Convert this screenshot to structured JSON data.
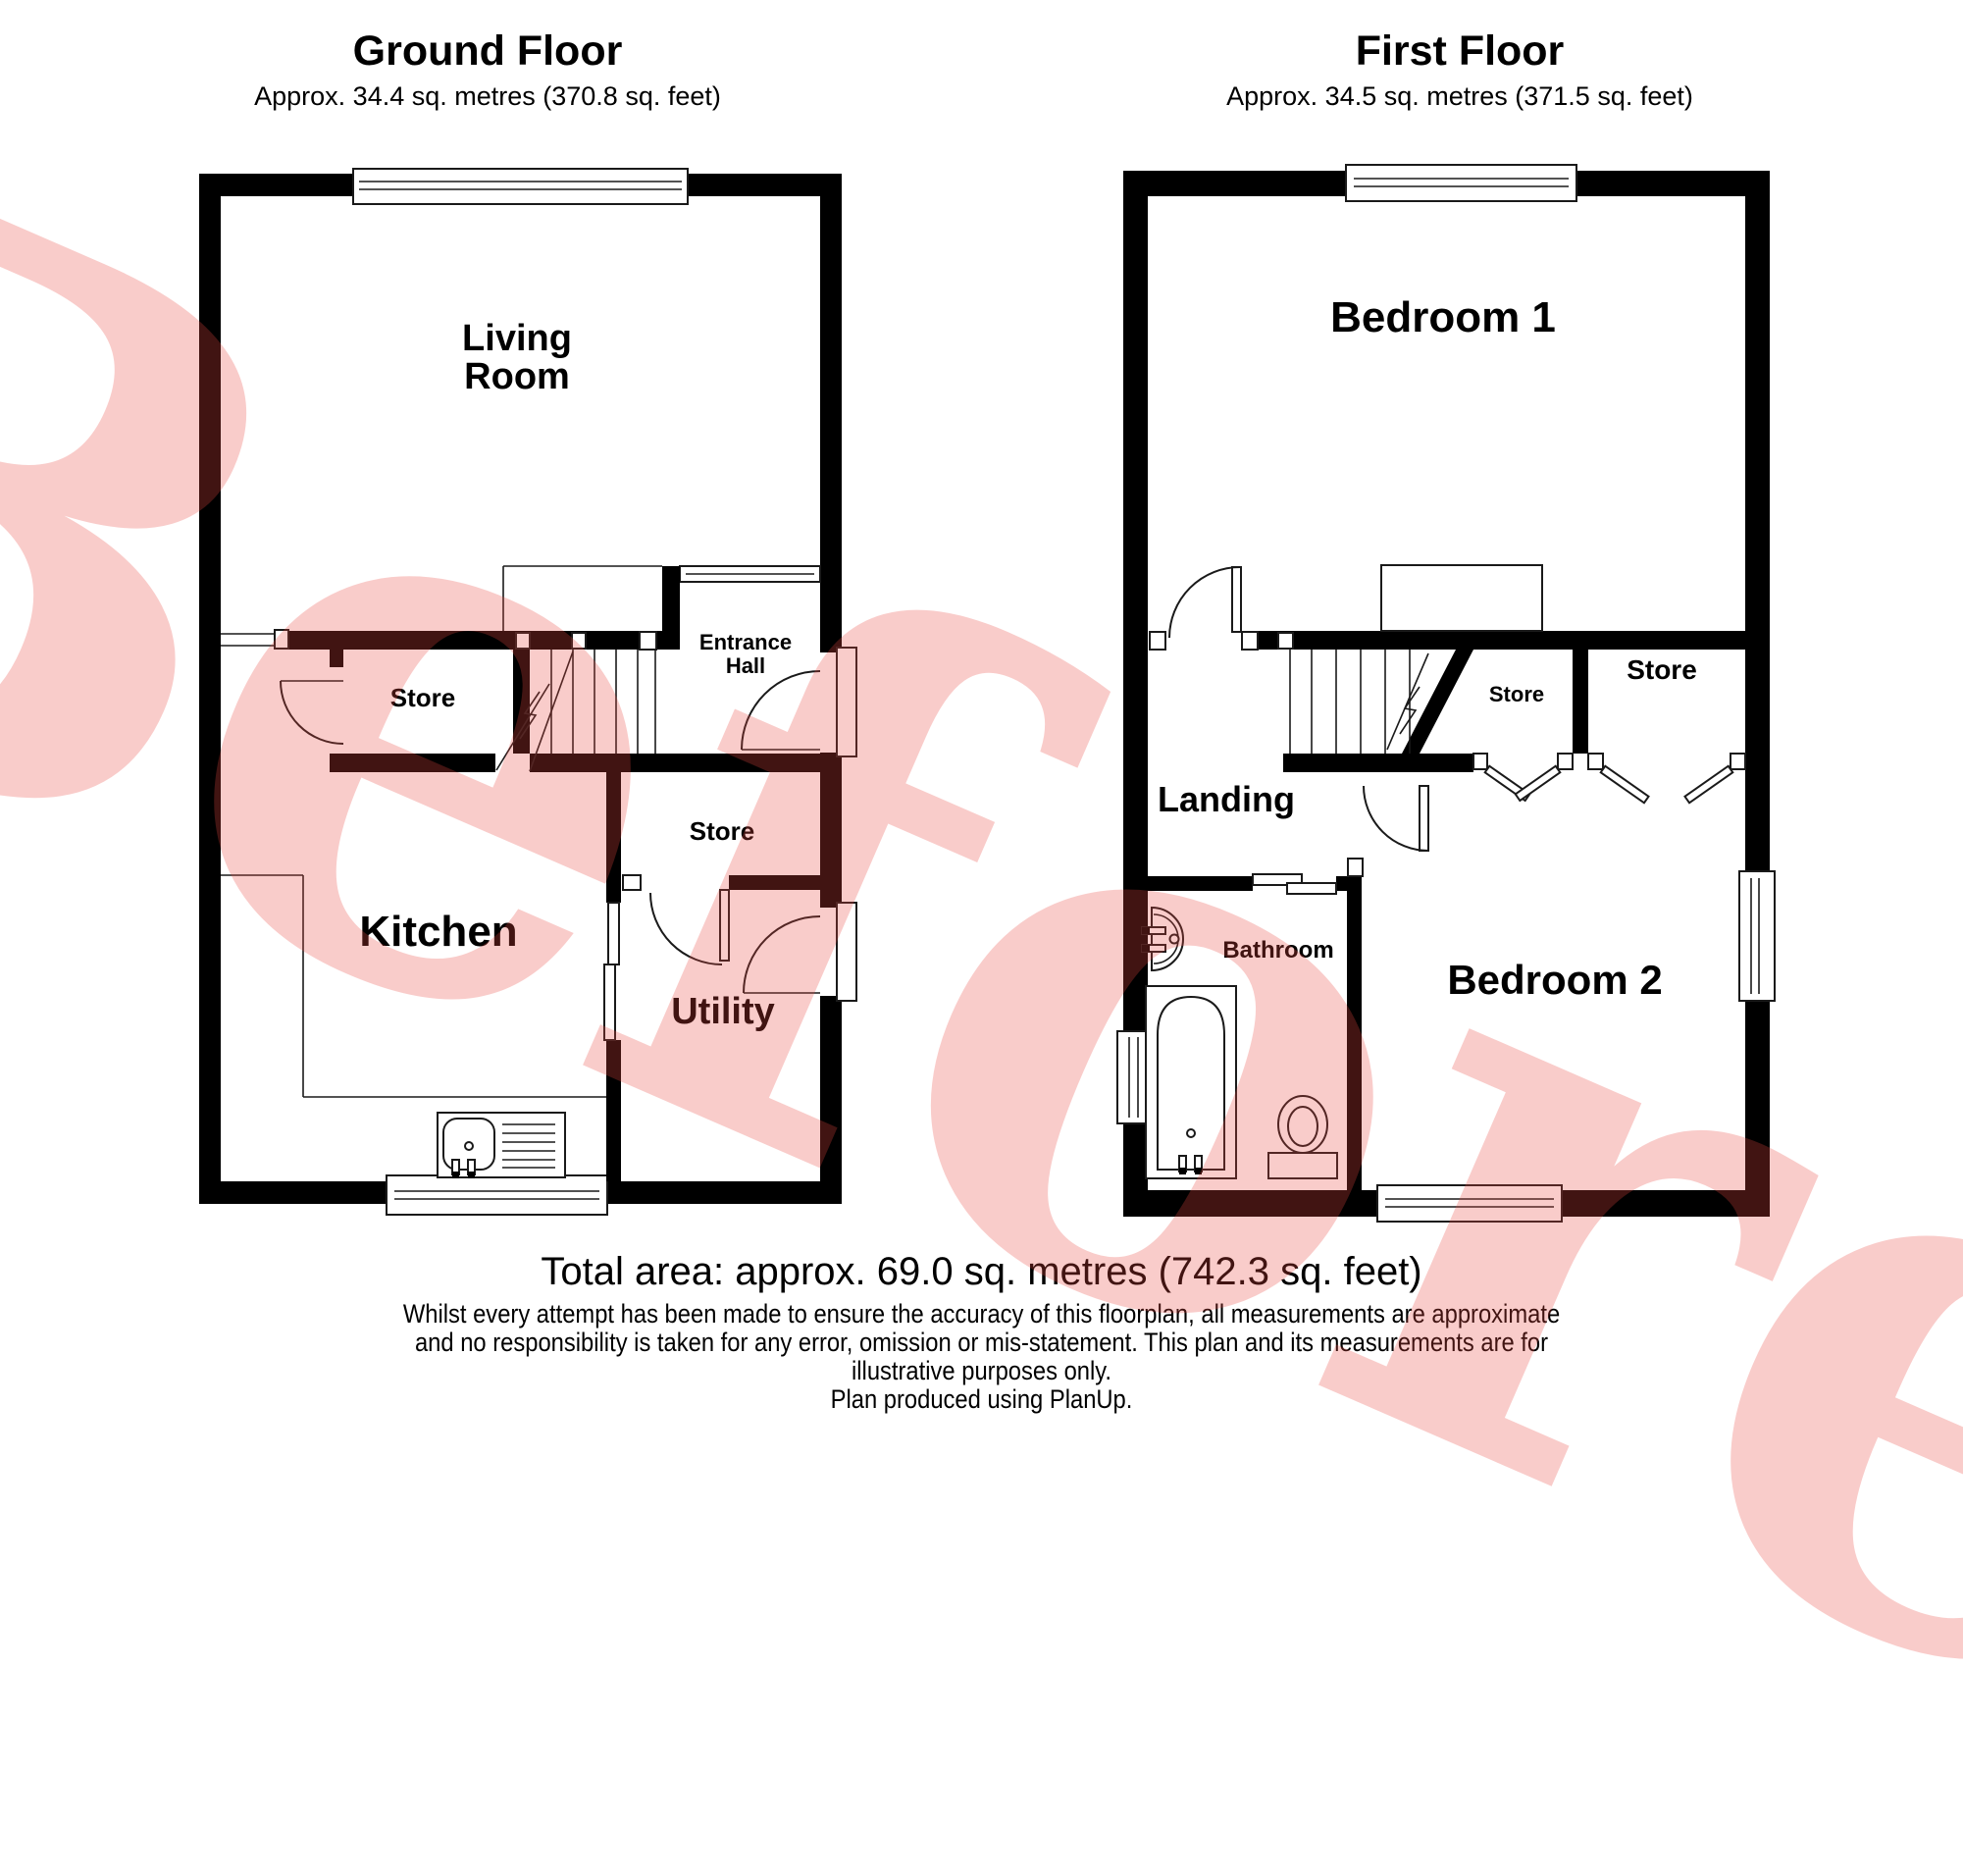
{
  "watermark": {
    "text": "Before",
    "color": "rgba(234,72,66,0.28)"
  },
  "ground_floor": {
    "title": "Ground Floor",
    "subtitle": "Approx. 34.4 sq. metres (370.8 sq. feet)",
    "rooms": {
      "living_room_line1": "Living",
      "living_room_line2": "Room",
      "store_1": "Store",
      "entrance_hall_line1": "Entrance",
      "entrance_hall_line2": "Hall",
      "store_2": "Store",
      "kitchen": "Kitchen",
      "utility": "Utility"
    }
  },
  "first_floor": {
    "title": "First Floor",
    "subtitle": "Approx. 34.5 sq. metres (371.5 sq. feet)",
    "rooms": {
      "bedroom_1": "Bedroom 1",
      "store_1": "Store",
      "store_2": "Store",
      "landing": "Landing",
      "bathroom": "Bathroom",
      "bedroom_2": "Bedroom 2"
    }
  },
  "footer": {
    "total_area": "Total area: approx. 69.0 sq. metres (742.3 sq. feet)",
    "disclaimer_line1": "Whilst every attempt has been made to ensure the accuracy of this floorplan, all measurements are approximate",
    "disclaimer_line2": "and no responsibility is taken for any error, omission or mis-statement. This plan and its measurements are for",
    "disclaimer_line3": "illustrative purposes only.",
    "credit": "Plan produced using PlanUp."
  }
}
